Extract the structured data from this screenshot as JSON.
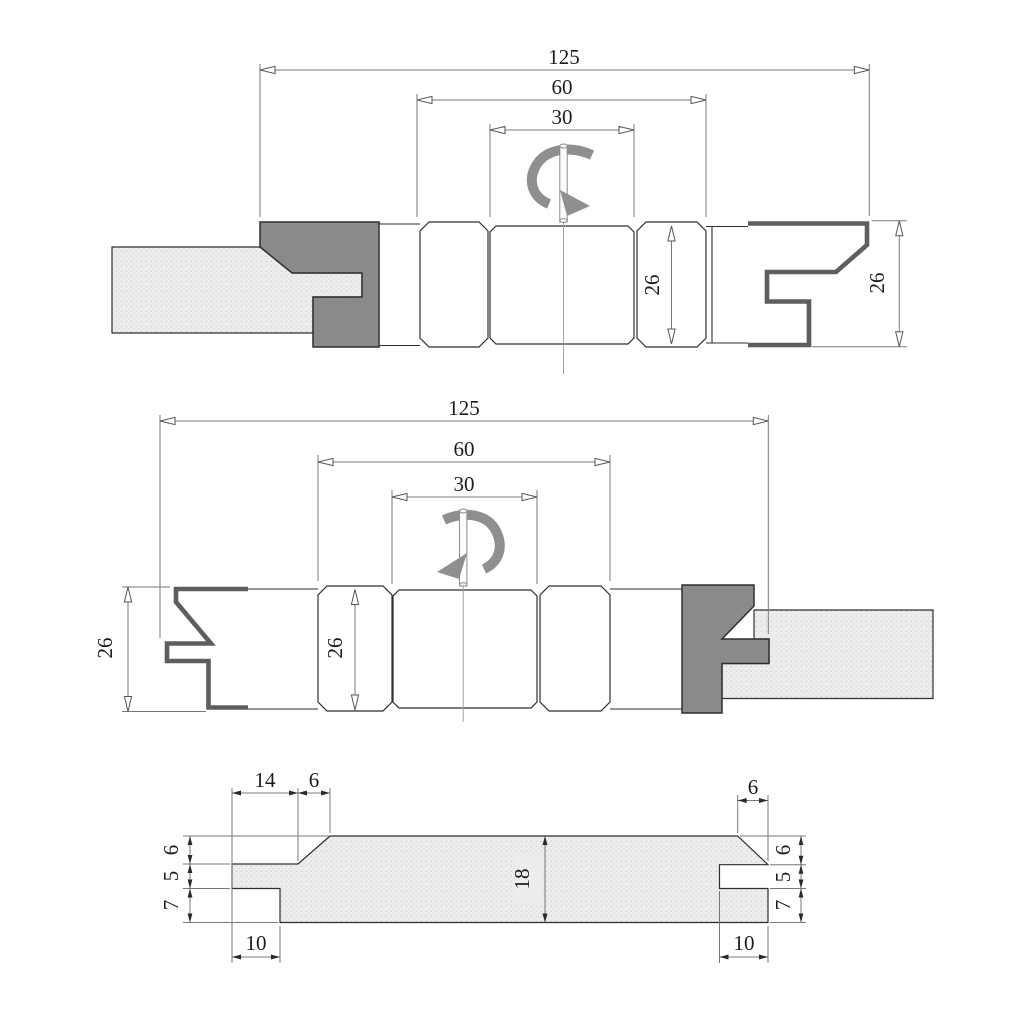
{
  "drawing_type": "technical-drawing-tongue-and-groove-cutter-set",
  "colors": {
    "head_gray": "#8a8a8a",
    "knife_gray": "#5e5e5e",
    "arrow_gray": "#8f8f8f",
    "line": "#2e2e2e",
    "dim": "#787878",
    "dim_text": "#1c1c1c",
    "board_fill": "#ededed",
    "board_dot": "#c9c9c9",
    "bg": "#ffffff"
  },
  "views": {
    "top_assembly": {
      "length_overall": "125",
      "length_hub": "60",
      "length_center": "30",
      "width_hub": "26",
      "width_profile": "26"
    },
    "middle_assembly": {
      "length_overall": "125",
      "length_hub": "60",
      "length_center": "30",
      "width_profile": "26",
      "width_hub": "26"
    },
    "board_profile": {
      "tongue_face_width": "14",
      "chamfer_left": "6",
      "edge_top_left": "6",
      "tongue_thickness": "5",
      "edge_bottom_left": "7",
      "tongue_length": "10",
      "board_thickness": "18",
      "chamfer_right": "6",
      "edge_top_right": "6",
      "groove_width": "5",
      "edge_bottom_right": "7",
      "groove_depth": "10"
    }
  }
}
